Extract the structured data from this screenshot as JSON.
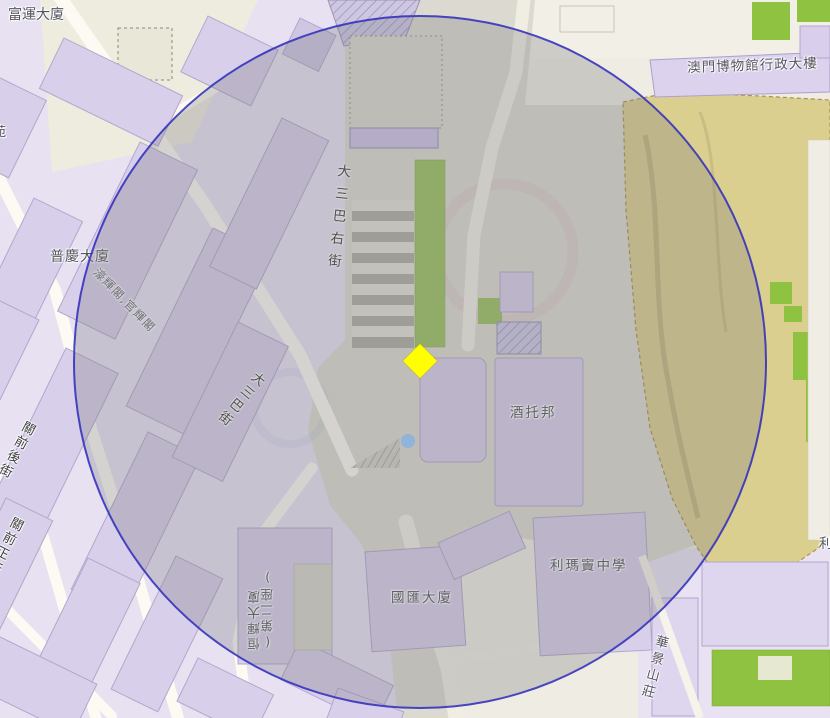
{
  "map": {
    "type": "street-map",
    "location": "澳門 大三巴 / Ruins of St. Paul's area",
    "overlay": {
      "shape": "circle",
      "stroke_color": "#2f2dbe",
      "fill_color": "rgba(122,122,128,0.30)"
    },
    "markers": {
      "selected_location": {
        "shape": "diamond",
        "color": "#ffff00"
      },
      "poi_dot": {
        "shape": "circle",
        "color": "#8fb3d9"
      }
    },
    "colors": {
      "building_fill": "#d8cfea",
      "building_stroke": "#b3a7cc",
      "road_fill": "#fdfaf3",
      "green_area": "#8fc241",
      "fort_area": "#dbcf8f",
      "plaza_gray": "#dcdad0",
      "landuse_purple": "#e7e1f1",
      "landuse_cream": "#eeebdf"
    }
  },
  "labels": {
    "fuwan": "富運大廈",
    "museum_admin": "澳門博物館行政大樓",
    "puqing": "普慶大廈",
    "haofai_kunfai": "濠輝閣,官輝閣",
    "st_paul_right_street": "大三巴右街",
    "st_paul_street": "大三巴街",
    "guanqian_back_street": "關前後街",
    "guanqian_main_street": "關前正街",
    "jiutuobang": "酒托邦",
    "ricci_college": "利瑪竇中學",
    "guohui": "國匯大廈",
    "hengfai": "恒輝大廈",
    "hengfai_block": "(第二座)",
    "huajing": "華景山莊",
    "edge_fragment_left": "苑",
    "edge_fragment_right": "利"
  }
}
